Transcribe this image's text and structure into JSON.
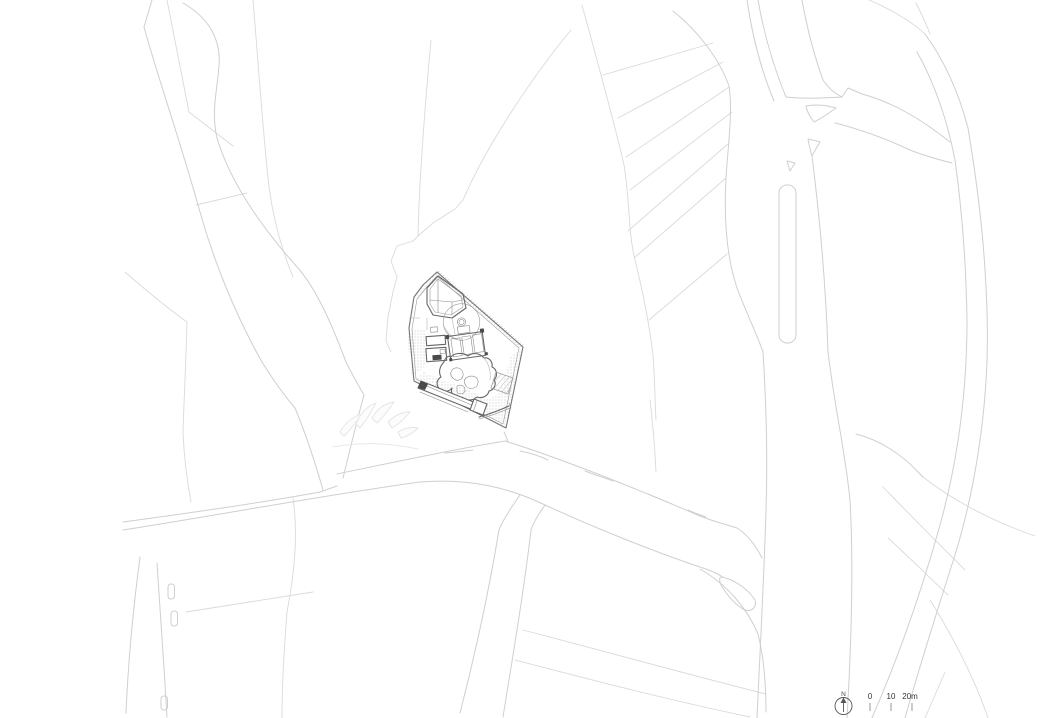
{
  "drawing": {
    "kind": "architectural-site-plan",
    "background": "#ffffff"
  },
  "legend": {
    "north_label": "N",
    "scale": {
      "zero": "0",
      "ten": "10",
      "twenty": "20m"
    }
  },
  "colors": {
    "road_line": "#cfcfcf",
    "parcel_line": "#dadada",
    "site_outline": "#757575",
    "detail_dark": "#4a4a4a",
    "texture_dot": "#aaaaaa",
    "legend_text": "#333333"
  }
}
